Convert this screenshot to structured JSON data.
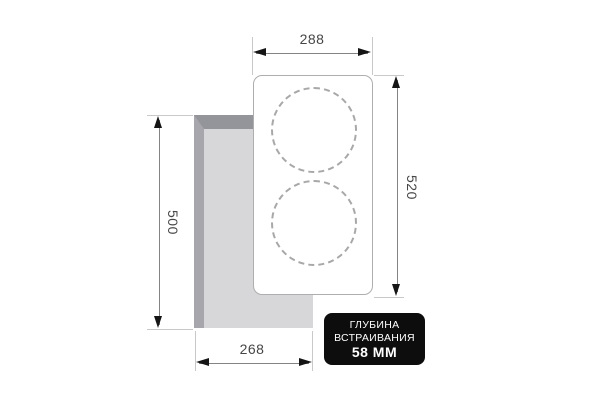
{
  "dimensions": {
    "hob_width": "288",
    "hob_height": "520",
    "cutout_height": "500",
    "cutout_width": "268"
  },
  "badge": {
    "line1": "ГЛУБИНА",
    "line2": "ВСТРАИВАНИЯ",
    "line3": "58 ММ",
    "bg_color": "#0d0d0d",
    "text_color": "#ffffff"
  },
  "hob": {
    "burner_circles": 2
  },
  "colors": {
    "background": "#ffffff",
    "dimension_line": "#848484",
    "extension_line": "#c9c9c9",
    "arrowhead": "#151515",
    "dimension_text": "#464646",
    "cutout_fill": "#d7d7da",
    "cutout_bevel_top": "#94949b",
    "cutout_bevel_left": "#a6a6ac",
    "hob_border": "#aeaeae",
    "burner_dash": "#a8a8a8"
  }
}
